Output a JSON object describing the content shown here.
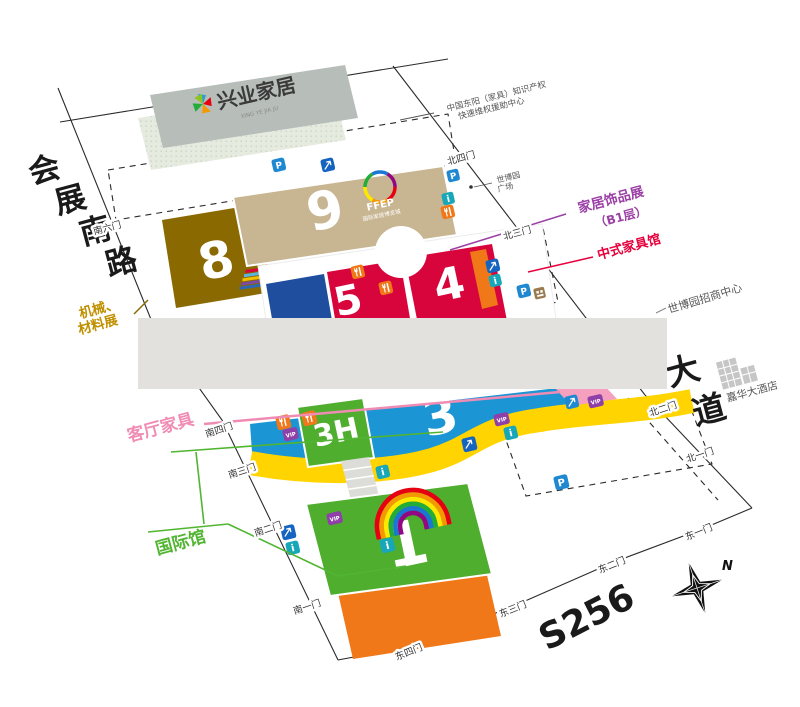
{
  "map": {
    "building_top": {
      "name": "兴业家居",
      "subtext": "XING YE JIA JU"
    },
    "hall9_brand": {
      "name": "FFEP",
      "subtitle": "国际家居博览城"
    },
    "halls": {
      "h8": "8",
      "h9": "9",
      "h5": "5",
      "h4": "4",
      "h3": "3",
      "h3h": "3H",
      "h1": "1"
    },
    "roads": {
      "west": [
        "会",
        "展",
        "南",
        "路"
      ],
      "avenue": [
        "大",
        "道"
      ],
      "highway": "S256"
    },
    "gates": {
      "south": [
        "南一门",
        "南二门",
        "南三门",
        "南四门",
        "南六门"
      ],
      "east": [
        "东一门",
        "东二门",
        "东三门",
        "东四门"
      ],
      "north": [
        "北一门",
        "北二门",
        "北三门",
        "北四门"
      ]
    },
    "callouts": {
      "machinery_1": "机械、",
      "machinery_2": "材料展",
      "living_room": "客厅家具",
      "international": "国际馆",
      "decor_1": "家居饰品展",
      "decor_2": "（B1层）",
      "chinese_furniture": "中式家具馆",
      "investment_center": "世博园招商中心",
      "plaza_1": "世博园",
      "plaza_2": "广场",
      "hotel": "嘉华大酒店",
      "ip_1": "中国东阳（家具）知识产权",
      "ip_2": "快速维权援助中心"
    },
    "icons": {
      "parking": "P",
      "info": "i",
      "vip": "VIP"
    },
    "compass_n": "N"
  },
  "colors": {
    "hall8": "#8a6900",
    "hall9": "#c8b591",
    "hall_red": "#d8043c",
    "hall_dark_blue": "#1f4e9e",
    "hall3_blue": "#1b95d4",
    "hall_green": "#4fae2e",
    "hall_orange": "#f07818",
    "band_yellow": "#ffd400",
    "label_pink": "#f08cb4",
    "label_green": "#52b532",
    "label_purple": "#9b3fa5",
    "label_red": "#e8003c",
    "label_gold": "#c09000",
    "icon_parking": "#1e88d0",
    "icon_info": "#18a7b8",
    "icon_vip": "#8e3fa8",
    "icon_restaurant": "#f07818",
    "icon_escalator": "#1565c0",
    "censor_gray": "#e3e1dd"
  }
}
